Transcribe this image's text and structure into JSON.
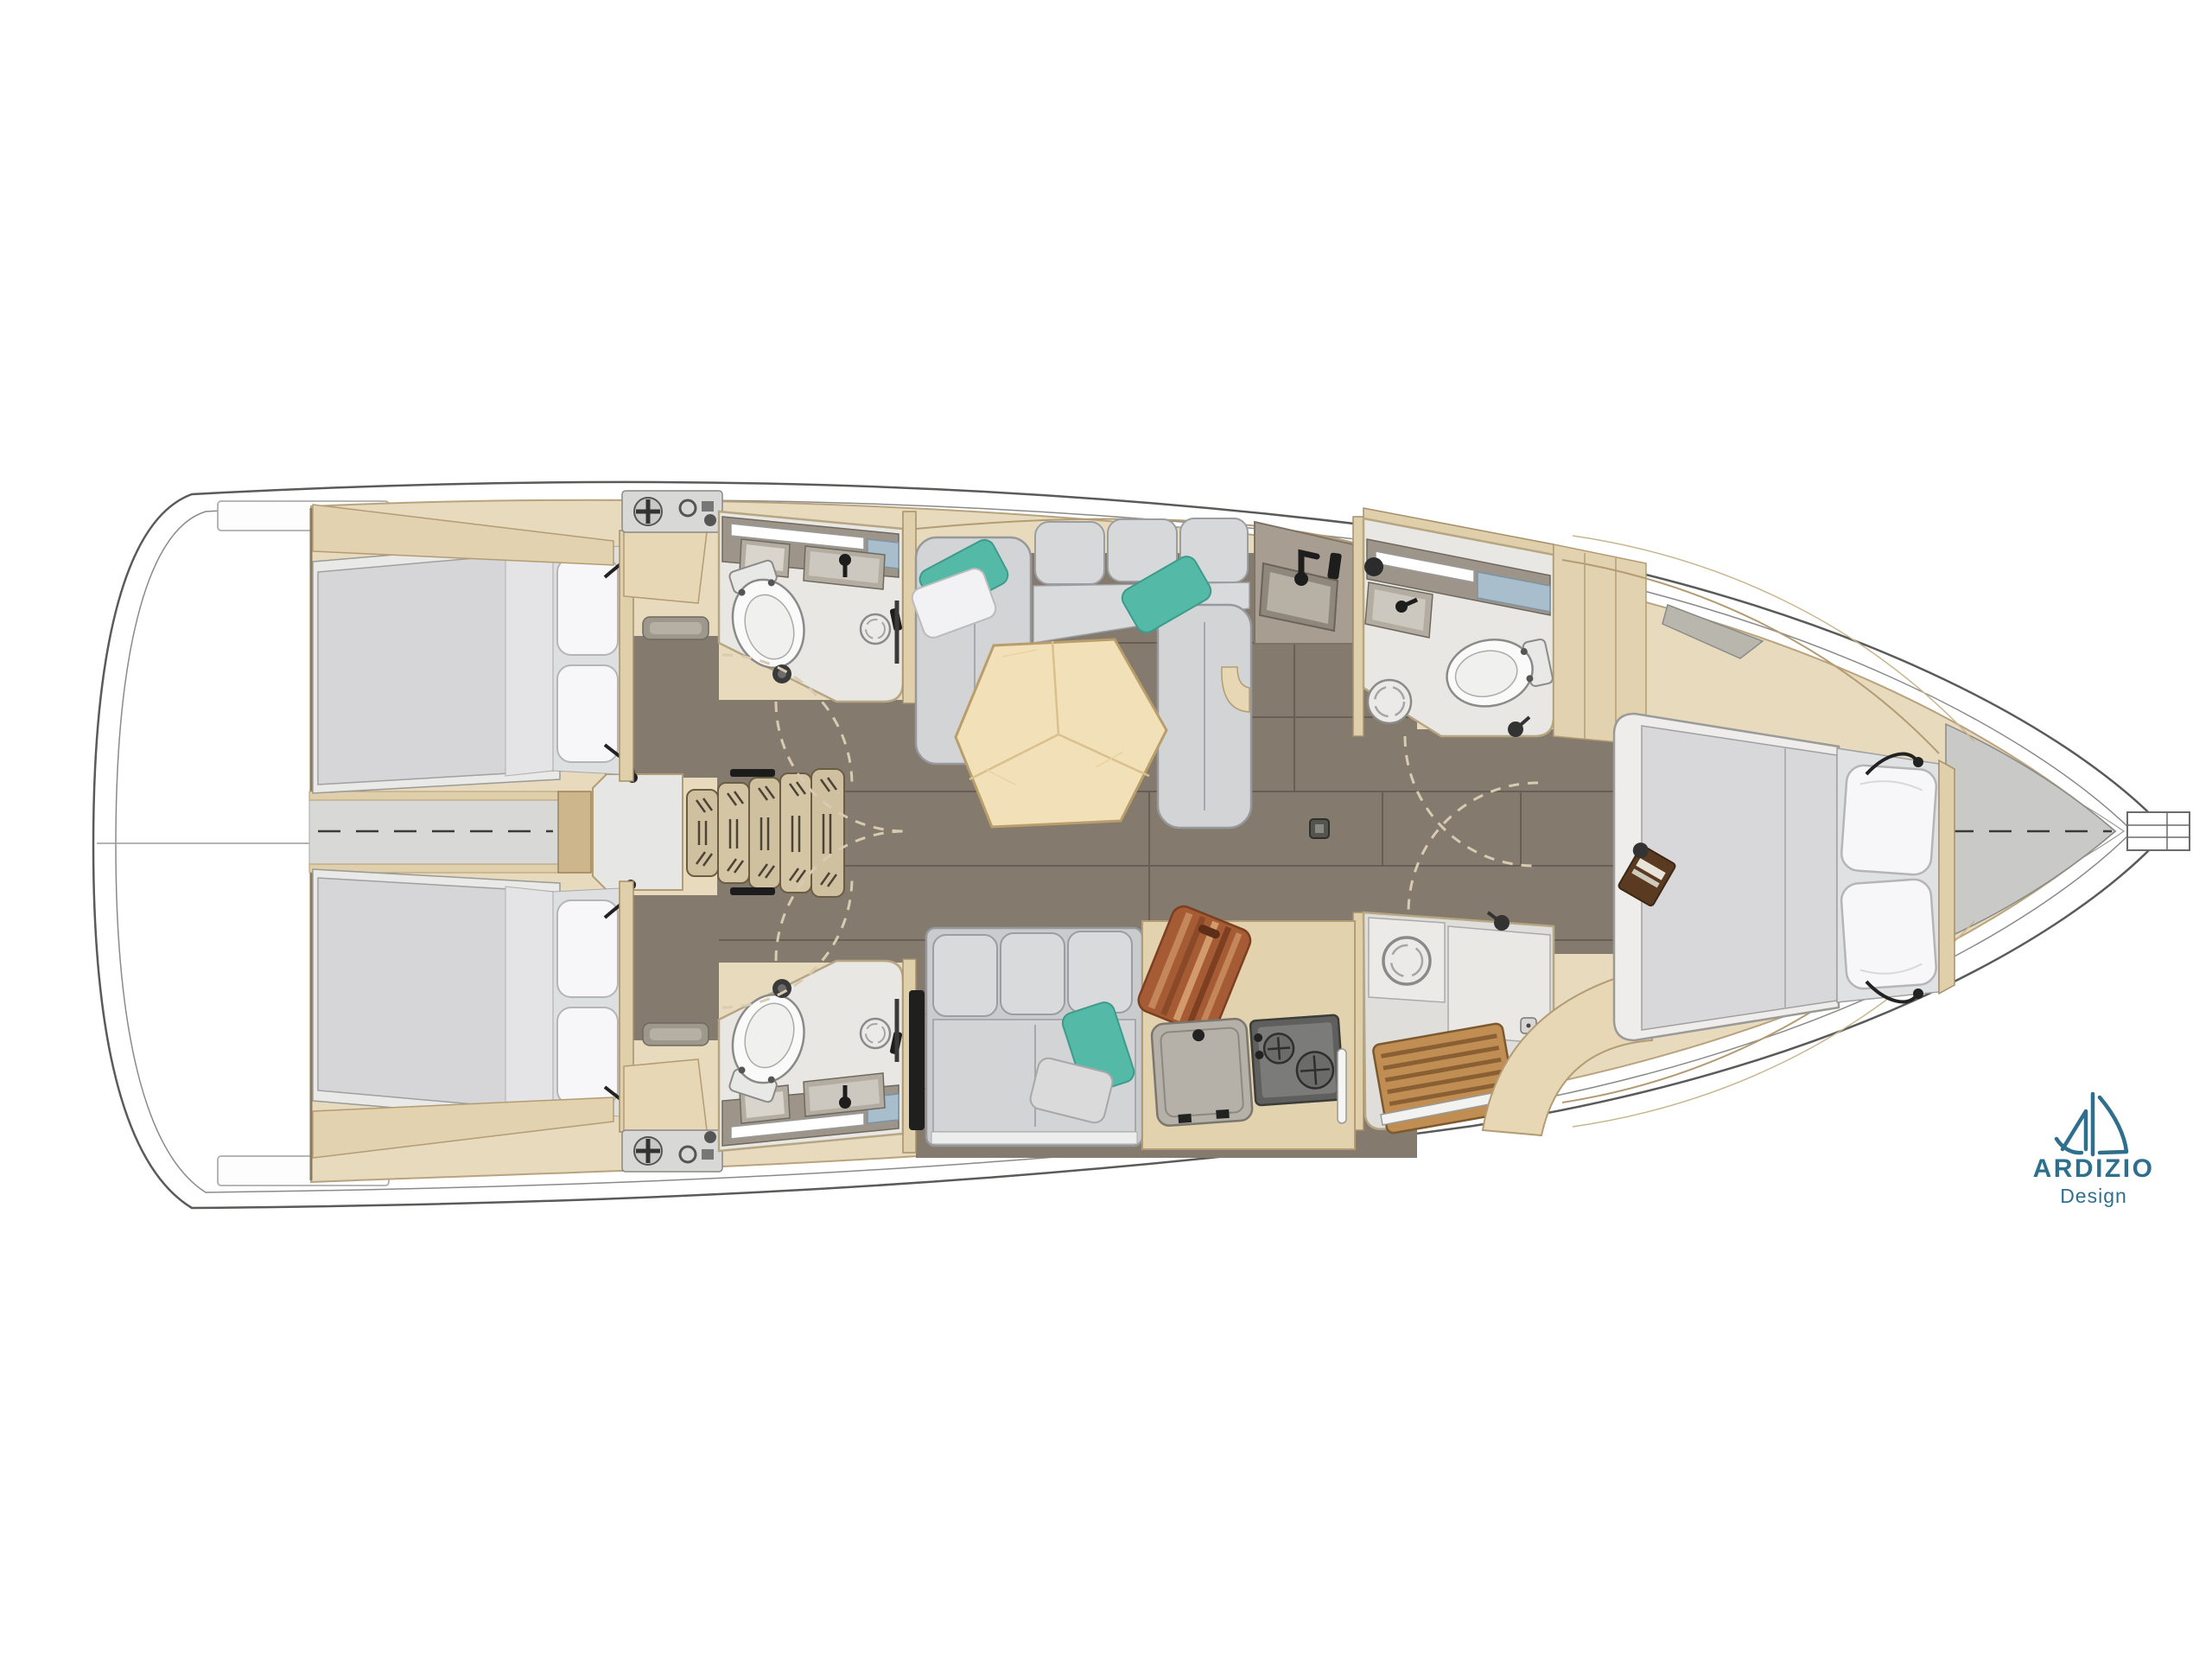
{
  "logo": {
    "brand": "ARDIZIO",
    "subtitle": "Design",
    "color": "#2e6f8e",
    "icon": "sailboat-logo-icon"
  },
  "plan": {
    "type": "yacht-interior-floor-plan",
    "view": "top-down",
    "bow": "right",
    "stern": "left",
    "areas": [
      "stern-lazarette",
      "aft-cabin-port",
      "aft-cabin-starboard",
      "head-aft-port",
      "head-aft-starboard",
      "companionway-stairs",
      "engine-compartment",
      "saloon-c-sofa",
      "hexagonal-table",
      "galley-port-counter",
      "settee-starboard",
      "galley-starboard",
      "head-forward",
      "shower-forward",
      "forward-owner-cabin",
      "foredeck"
    ]
  },
  "palette": {
    "hull_line": "#5a5a58",
    "deck_white": "#ffffff",
    "liner_wood": "#e8dabd",
    "wood_trim": "#dfcfab",
    "wood_edge": "#b39c74",
    "floor_dark": "#847b6e",
    "floor_seam": "#675f54",
    "bath_floor": "#e8e7e3",
    "counter_taupe": "#9d9589",
    "mattress_grey": "#d7d7d9",
    "pillow_white": "#f7f7f9",
    "sofa_grey": "#d2d4d6",
    "accent_teal": "#55b9a8",
    "table_wood": "#f2e0b8",
    "stairs_wood": "#cfc0a0",
    "teak": "#c08d53",
    "cutting_board": "#a55c34",
    "mirror_glass": "#a9becd",
    "foredeck_grey": "#c9c9c7"
  }
}
